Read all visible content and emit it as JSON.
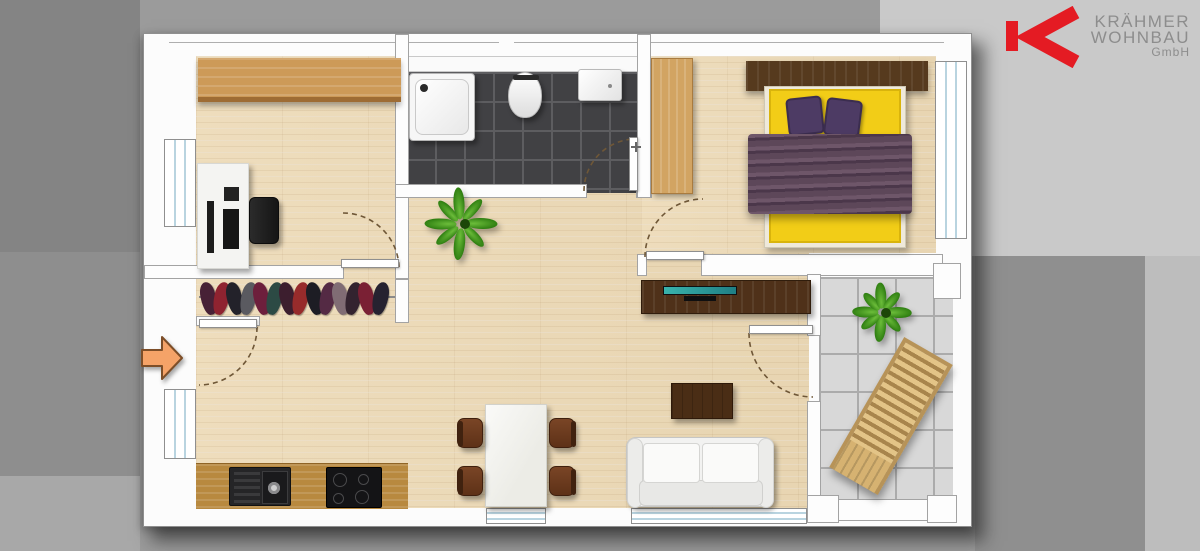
{
  "logo": {
    "line1": "KRÄHMER",
    "line2": "WOHNBAU",
    "line3": "GmbH",
    "mark_color": "#e41b23",
    "text_color": "#8d8d8d"
  },
  "palette": {
    "background_base": "#9b9b9b",
    "background_dark_patch": "#848484",
    "background_light_patch": "#c9c9c9",
    "plan_card": "#fcfcfc",
    "floor_wood": "#ecd9b5",
    "counter_wood": "#b8893f",
    "cabinet_wood": "#cd9a58",
    "dark_wood": "#4f3119",
    "bathroom_tile": "#414144",
    "balcony_tile": "#d8d8d8",
    "bed_yellow": "#f2cd17",
    "bedding_purple": "#5d4759",
    "pillow_purple": "#4d3b64",
    "window_glass": "#b9d4e0",
    "entrance_arrow": "#f5a368",
    "plant_green": "#3f9b1e",
    "tv_screen_teal": "#2fa9a2",
    "door_swing_line": "#6f5737"
  },
  "floor_plan_icons": [
    "office-cabinet",
    "office-desk",
    "office-chair",
    "coat-rack",
    "entrance-arrow",
    "shower-tray",
    "toilet",
    "bathroom-sink",
    "bathroom-door",
    "wardrobe",
    "headboard-shelf",
    "double-bed",
    "pillows",
    "blanket",
    "bedroom-window",
    "houseplant",
    "tv-sideboard",
    "tv",
    "coffee-table",
    "sofa",
    "dining-table",
    "dining-chair",
    "kitchen-counter",
    "kitchen-sink",
    "cooktop",
    "balcony-plant",
    "sun-lounger",
    "balcony-tiles"
  ],
  "coat_rack": {
    "item_colors": [
      "#472136",
      "#8f2330",
      "#23222a",
      "#5a5a60",
      "#6d1f3c",
      "#2c4a44",
      "#3c1e2e",
      "#972b2b",
      "#1d1d24",
      "#542a44",
      "#806c74",
      "#33232f",
      "#7a2034",
      "#262230"
    ]
  }
}
